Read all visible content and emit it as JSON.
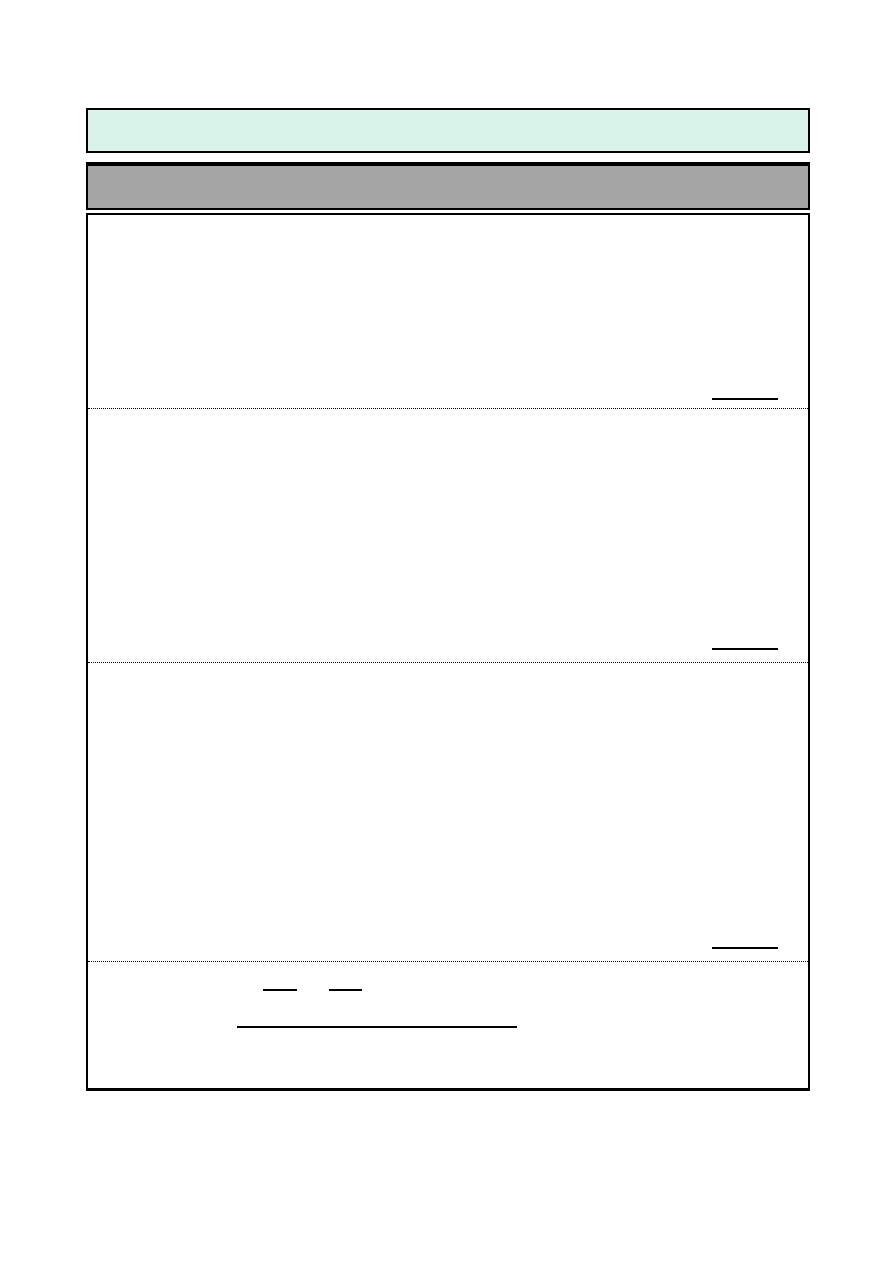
{
  "colors": {
    "page_background": "#ffffff",
    "header_band_fill": "#d9f2ea",
    "title_bar_fill": "#a6a6a6",
    "border": "#000000"
  },
  "header_band": {
    "text": ""
  },
  "title_bar": {
    "text": ""
  },
  "sections": [
    {
      "label": "",
      "answer_blank_value": ""
    },
    {
      "label": "",
      "answer_blank_value": ""
    },
    {
      "label": "",
      "answer_blank_value": ""
    }
  ],
  "footer_section": {
    "short_blank_1_value": "",
    "short_blank_2_value": "",
    "long_blank_value": ""
  }
}
